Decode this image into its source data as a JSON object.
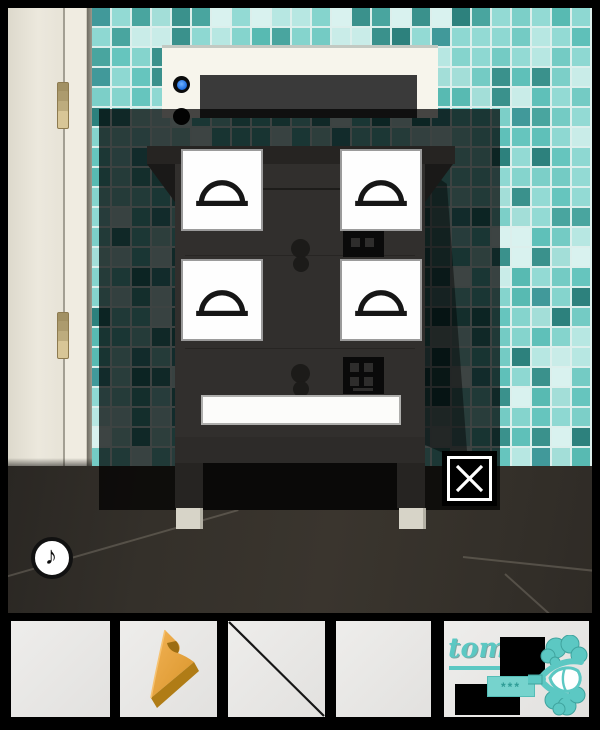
{
  "game": {
    "accent_teal": "#5cc8c3",
    "scene_name": "tiled-bathroom-with-cabinet-popup"
  },
  "scene": {
    "wall_grout": "#dcefec",
    "wall_palette": [
      "#7ccfc8",
      "#58bab2",
      "#a3ded8",
      "#c9ece8",
      "#49a59f",
      "#85d4cd",
      "#b7e7e2",
      "#3a918c",
      "#93dad4",
      "#2d817d",
      "#d9f2ef",
      "#66c5be",
      "#41999a",
      "#74cbc4",
      "#5fc0b9",
      "#8ed8d2"
    ],
    "door": {
      "color": "#ece8dd",
      "hinge_color": "#d8c697",
      "hinge_count": 2
    },
    "appliance": {
      "body_color": "#f7f5ec",
      "panel_color": "#3a3a3a",
      "led_on_color": "#2f7df6",
      "led_off_color": "#0b0b0b"
    },
    "floor_color": "#34302a"
  },
  "popup": {
    "overlay_opacity": 0.72,
    "cabinet_color": "#312f2d",
    "papers": [
      {
        "symbol": "dome"
      },
      {
        "symbol": "dome"
      },
      {
        "symbol": "dome"
      },
      {
        "symbol": "dome"
      }
    ],
    "mini_panels": [
      {
        "pips": 2
      },
      {
        "pips": 4
      }
    ],
    "blank_plate_text": "",
    "close_symbol": "✕"
  },
  "sound_button": {
    "symbol": "♪"
  },
  "inventory": {
    "slots": [
      {
        "index": 1,
        "item": null
      },
      {
        "index": 2,
        "item": "yellow-wedge-piece"
      },
      {
        "index": 3,
        "item": "thin-black-rod"
      },
      {
        "index": 4,
        "item": null
      },
      {
        "index": 5,
        "item": "maker-logo"
      }
    ]
  },
  "logo": {
    "text": "tom",
    "badge_text": "***",
    "key_icon": "clover-key"
  }
}
